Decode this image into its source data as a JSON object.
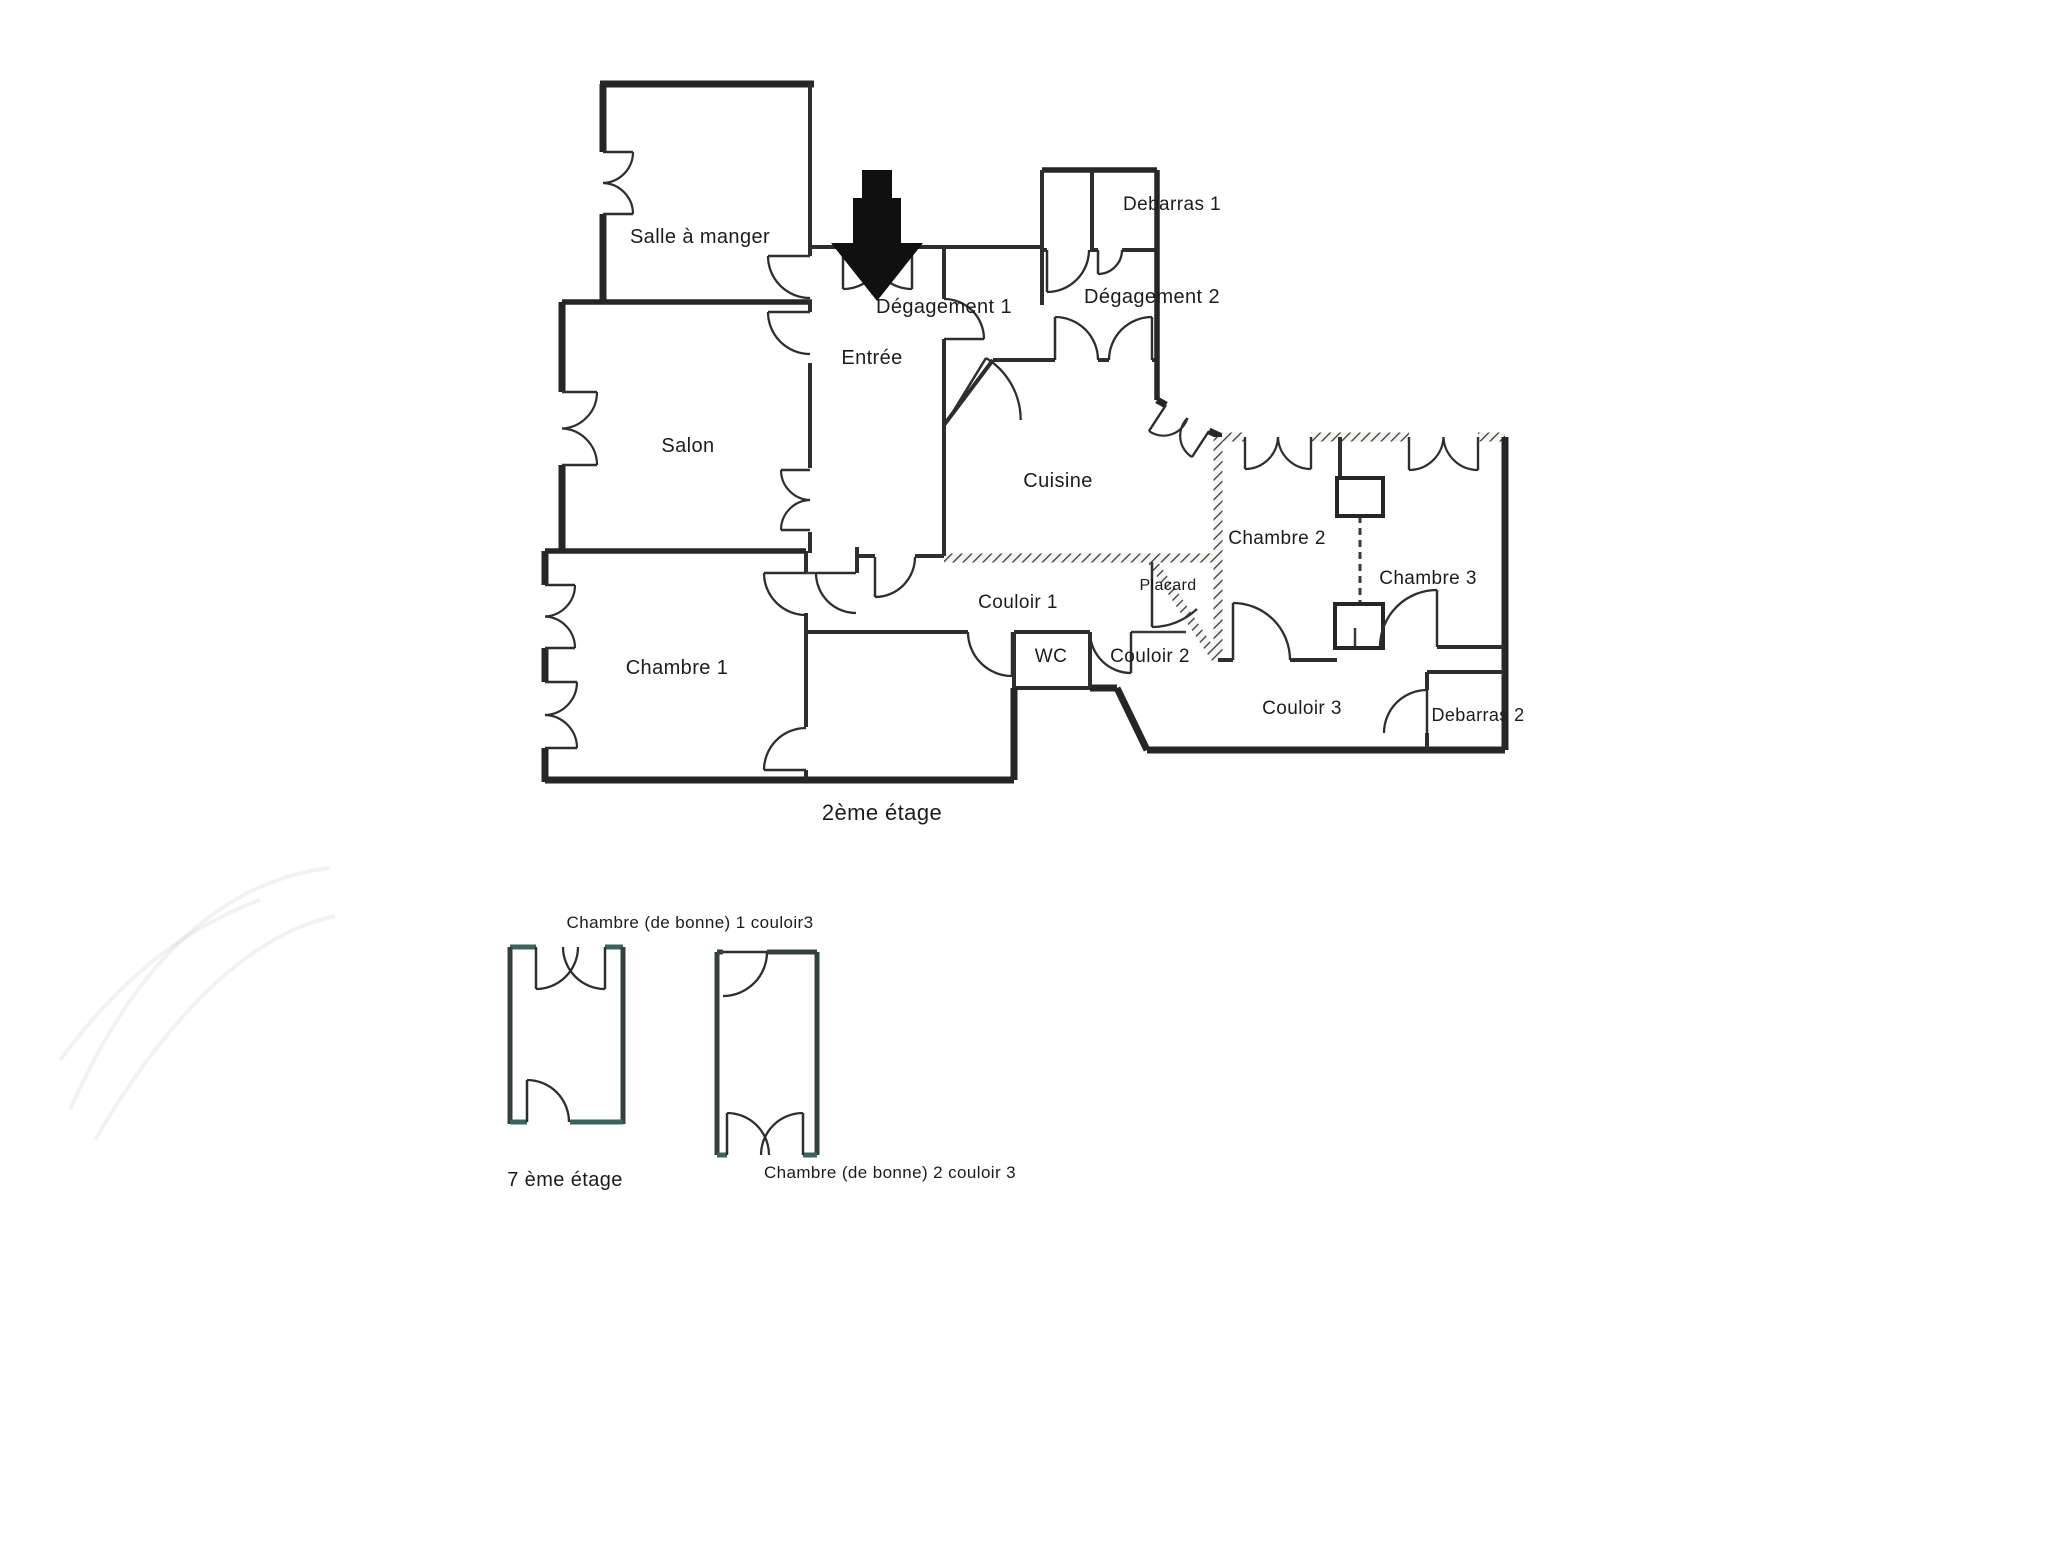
{
  "page": {
    "type": "scanned-floor-plan",
    "background": "#ffffff",
    "ink": "#262626",
    "teal_accent": "#3c635b"
  },
  "plan": {
    "floor_titles": [
      {
        "name": "floor-title-2eme-etage",
        "text": "2ème étage",
        "x": 882,
        "y": 820,
        "size": 22
      },
      {
        "name": "floor-title-7eme-etage",
        "text": "7 ème étage",
        "x": 565,
        "y": 1186,
        "size": 20
      }
    ],
    "labels": [
      {
        "name": "salle-a-manger",
        "text": "Salle à manger",
        "x": 700,
        "y": 243,
        "size": 20
      },
      {
        "name": "salon",
        "text": "Salon",
        "x": 688,
        "y": 452,
        "size": 20
      },
      {
        "name": "chambre-1",
        "text": "Chambre 1",
        "x": 677,
        "y": 674,
        "size": 20
      },
      {
        "name": "entree",
        "text": "Entrée",
        "x": 872,
        "y": 364,
        "size": 20
      },
      {
        "name": "degagement-1",
        "text": "Dégagement 1",
        "x": 944,
        "y": 313,
        "size": 20
      },
      {
        "name": "degagement-2",
        "text": "Dégagement 2",
        "x": 1152,
        "y": 303,
        "size": 20
      },
      {
        "name": "debarras-1",
        "text": "Debarras 1",
        "x": 1172,
        "y": 210,
        "size": 19
      },
      {
        "name": "cuisine",
        "text": "Cuisine",
        "x": 1058,
        "y": 487,
        "size": 20
      },
      {
        "name": "chambre-2",
        "text": "Chambre 2",
        "x": 1277,
        "y": 544,
        "size": 19
      },
      {
        "name": "chambre-3",
        "text": "Chambre 3",
        "x": 1428,
        "y": 584,
        "size": 19
      },
      {
        "name": "placard",
        "text": "Placard",
        "x": 1168,
        "y": 590,
        "size": 16
      },
      {
        "name": "couloir-1",
        "text": "Couloir 1",
        "x": 1018,
        "y": 608,
        "size": 19
      },
      {
        "name": "wc",
        "text": "WC",
        "x": 1051,
        "y": 662,
        "size": 19
      },
      {
        "name": "couloir-2",
        "text": "Couloir 2",
        "x": 1150,
        "y": 662,
        "size": 19
      },
      {
        "name": "couloir-3",
        "text": "Couloir 3",
        "x": 1302,
        "y": 714,
        "size": 19
      },
      {
        "name": "debarras-2",
        "text": "Debarras 2",
        "x": 1478,
        "y": 721,
        "size": 18
      },
      {
        "name": "chambre-bonne-1",
        "text": "Chambre (de bonne) 1 couloir3",
        "x": 690,
        "y": 928,
        "size": 17
      },
      {
        "name": "chambre-bonne-2",
        "text": "Chambre (de bonne) 2 couloir 3",
        "x": 890,
        "y": 1178,
        "size": 17
      }
    ],
    "walls": [
      {
        "x1": 600,
        "y1": 84,
        "x2": 814,
        "y2": 84,
        "t": "ext"
      },
      {
        "x1": 603,
        "y1": 84,
        "x2": 603,
        "y2": 152,
        "t": "ext"
      },
      {
        "x1": 603,
        "y1": 214,
        "x2": 603,
        "y2": 302,
        "t": "ext"
      },
      {
        "x1": 562,
        "y1": 302,
        "x2": 562,
        "y2": 392,
        "t": "ext"
      },
      {
        "x1": 562,
        "y1": 465,
        "x2": 562,
        "y2": 551,
        "t": "ext"
      },
      {
        "x1": 562,
        "y1": 302,
        "x2": 812,
        "y2": 302,
        "t": "mid"
      },
      {
        "x1": 545,
        "y1": 551,
        "x2": 806,
        "y2": 551,
        "t": "mid"
      },
      {
        "x1": 545,
        "y1": 551,
        "x2": 545,
        "y2": 585,
        "t": "ext"
      },
      {
        "x1": 545,
        "y1": 648,
        "x2": 545,
        "y2": 682,
        "t": "ext"
      },
      {
        "x1": 545,
        "y1": 748,
        "x2": 545,
        "y2": 782,
        "t": "ext"
      },
      {
        "x1": 545,
        "y1": 780,
        "x2": 1014,
        "y2": 780,
        "t": "ext"
      },
      {
        "x1": 810,
        "y1": 84,
        "x2": 810,
        "y2": 256,
        "t": "int"
      },
      {
        "x1": 810,
        "y1": 300,
        "x2": 810,
        "y2": 312,
        "t": "int"
      },
      {
        "x1": 810,
        "y1": 363,
        "x2": 810,
        "y2": 468,
        "t": "int"
      },
      {
        "x1": 810,
        "y1": 532,
        "x2": 810,
        "y2": 553,
        "t": "int"
      },
      {
        "x1": 806,
        "y1": 551,
        "x2": 806,
        "y2": 573,
        "t": "int"
      },
      {
        "x1": 806,
        "y1": 613,
        "x2": 806,
        "y2": 727,
        "t": "int"
      },
      {
        "x1": 806,
        "y1": 770,
        "x2": 806,
        "y2": 780,
        "t": "int"
      },
      {
        "x1": 806,
        "y1": 573,
        "x2": 816,
        "y2": 573,
        "t": "thin"
      },
      {
        "x1": 857,
        "y1": 547,
        "x2": 857,
        "y2": 573,
        "t": "int"
      },
      {
        "x1": 857,
        "y1": 556,
        "x2": 875,
        "y2": 556,
        "t": "int"
      },
      {
        "x1": 915,
        "y1": 556,
        "x2": 944,
        "y2": 556,
        "t": "int"
      },
      {
        "x1": 944,
        "y1": 558,
        "x2": 1218,
        "y2": 558,
        "t": "hatch"
      },
      {
        "x1": 810,
        "y1": 247,
        "x2": 843,
        "y2": 247,
        "t": "int"
      },
      {
        "x1": 912,
        "y1": 247,
        "x2": 1042,
        "y2": 247,
        "t": "int"
      },
      {
        "x1": 944,
        "y1": 247,
        "x2": 944,
        "y2": 299,
        "t": "int"
      },
      {
        "x1": 944,
        "y1": 339,
        "x2": 944,
        "y2": 556,
        "t": "int"
      },
      {
        "x1": 944,
        "y1": 425,
        "x2": 993,
        "y2": 360,
        "t": "int"
      },
      {
        "x1": 993,
        "y1": 360,
        "x2": 1055,
        "y2": 360,
        "t": "int"
      },
      {
        "x1": 1098,
        "y1": 360,
        "x2": 1109,
        "y2": 360,
        "t": "int"
      },
      {
        "x1": 1152,
        "y1": 360,
        "x2": 1157,
        "y2": 360,
        "t": "int"
      },
      {
        "x1": 1042,
        "y1": 170,
        "x2": 1157,
        "y2": 170,
        "t": "mid"
      },
      {
        "x1": 1042,
        "y1": 170,
        "x2": 1042,
        "y2": 305,
        "t": "int"
      },
      {
        "x1": 1092,
        "y1": 170,
        "x2": 1092,
        "y2": 250,
        "t": "int"
      },
      {
        "x1": 1042,
        "y1": 250,
        "x2": 1047,
        "y2": 250,
        "t": "int"
      },
      {
        "x1": 1090,
        "y1": 250,
        "x2": 1098,
        "y2": 250,
        "t": "int"
      },
      {
        "x1": 1122,
        "y1": 250,
        "x2": 1157,
        "y2": 250,
        "t": "int"
      },
      {
        "x1": 1157,
        "y1": 170,
        "x2": 1157,
        "y2": 400,
        "t": "mid"
      },
      {
        "x1": 1157,
        "y1": 400,
        "x2": 1166,
        "y2": 405,
        "t": "ext"
      },
      {
        "x1": 1209,
        "y1": 431,
        "x2": 1222,
        "y2": 437,
        "t": "ext"
      },
      {
        "x1": 1222,
        "y1": 437,
        "x2": 1245,
        "y2": 437,
        "t": "hatch"
      },
      {
        "x1": 1311,
        "y1": 437,
        "x2": 1409,
        "y2": 437,
        "t": "hatch"
      },
      {
        "x1": 1478,
        "y1": 437,
        "x2": 1505,
        "y2": 437,
        "t": "hatch"
      },
      {
        "x1": 1505,
        "y1": 437,
        "x2": 1505,
        "y2": 750,
        "t": "ext"
      },
      {
        "x1": 1147,
        "y1": 750,
        "x2": 1505,
        "y2": 750,
        "t": "ext"
      },
      {
        "x1": 1117,
        "y1": 688,
        "x2": 1147,
        "y2": 750,
        "t": "ext"
      },
      {
        "x1": 1090,
        "y1": 688,
        "x2": 1117,
        "y2": 688,
        "t": "ext"
      },
      {
        "x1": 1014,
        "y1": 688,
        "x2": 1090,
        "y2": 688,
        "t": "int"
      },
      {
        "x1": 1014,
        "y1": 632,
        "x2": 1014,
        "y2": 688,
        "t": "int"
      },
      {
        "x1": 1014,
        "y1": 688,
        "x2": 1014,
        "y2": 780,
        "t": "ext"
      },
      {
        "x1": 806,
        "y1": 632,
        "x2": 968,
        "y2": 632,
        "t": "int"
      },
      {
        "x1": 1014,
        "y1": 632,
        "x2": 1090,
        "y2": 632,
        "t": "int"
      },
      {
        "x1": 1131,
        "y1": 632,
        "x2": 1186,
        "y2": 632,
        "t": "thin"
      },
      {
        "x1": 1090,
        "y1": 632,
        "x2": 1090,
        "y2": 688,
        "t": "int"
      },
      {
        "x1": 1218,
        "y1": 437,
        "x2": 1218,
        "y2": 662,
        "t": "hatch"
      },
      {
        "x1": 1150,
        "y1": 558,
        "x2": 1218,
        "y2": 662,
        "t": "hatch"
      },
      {
        "x1": 1218,
        "y1": 660,
        "x2": 1233,
        "y2": 660,
        "t": "int"
      },
      {
        "x1": 1290,
        "y1": 660,
        "x2": 1337,
        "y2": 660,
        "t": "int"
      },
      {
        "x1": 1340,
        "y1": 437,
        "x2": 1340,
        "y2": 478,
        "t": "int"
      },
      {
        "x1": 1437,
        "y1": 647,
        "x2": 1505,
        "y2": 647,
        "t": "int"
      },
      {
        "x1": 1427,
        "y1": 672,
        "x2": 1505,
        "y2": 672,
        "t": "int"
      },
      {
        "x1": 1427,
        "y1": 672,
        "x2": 1427,
        "y2": 690,
        "t": "int"
      },
      {
        "x1": 1427,
        "y1": 733,
        "x2": 1427,
        "y2": 750,
        "t": "int"
      },
      {
        "x1": 510,
        "y1": 947,
        "x2": 536,
        "y2": 947,
        "t": "teal"
      },
      {
        "x1": 605,
        "y1": 947,
        "x2": 623,
        "y2": 947,
        "t": "teal"
      },
      {
        "x1": 510,
        "y1": 947,
        "x2": 510,
        "y2": 1124,
        "t": "ann"
      },
      {
        "x1": 623,
        "y1": 947,
        "x2": 623,
        "y2": 1124,
        "t": "ann"
      },
      {
        "x1": 510,
        "y1": 1122,
        "x2": 527,
        "y2": 1122,
        "t": "teal"
      },
      {
        "x1": 570,
        "y1": 1122,
        "x2": 623,
        "y2": 1122,
        "t": "teal"
      },
      {
        "x1": 717,
        "y1": 952,
        "x2": 723,
        "y2": 952,
        "t": "ann"
      },
      {
        "x1": 767,
        "y1": 952,
        "x2": 817,
        "y2": 952,
        "t": "ann"
      },
      {
        "x1": 717,
        "y1": 952,
        "x2": 717,
        "y2": 1155,
        "t": "ann"
      },
      {
        "x1": 817,
        "y1": 952,
        "x2": 817,
        "y2": 1155,
        "t": "ann"
      },
      {
        "x1": 717,
        "y1": 1155,
        "x2": 727,
        "y2": 1155,
        "t": "teal"
      },
      {
        "x1": 803,
        "y1": 1155,
        "x2": 817,
        "y2": 1155,
        "t": "teal"
      },
      {
        "x1": 1355,
        "y1": 628,
        "x2": 1355,
        "y2": 648,
        "t": "thin"
      }
    ],
    "dashed_walls": [
      {
        "x1": 1360,
        "y1": 516,
        "x2": 1360,
        "y2": 604,
        "t": "thin"
      }
    ],
    "chimney_rects": [
      {
        "x": 1337,
        "y": 478,
        "w": 46,
        "h": 38
      },
      {
        "x": 1335,
        "y": 604,
        "w": 48,
        "h": 44
      }
    ],
    "doors": [
      {
        "h": [
          810,
          256
        ],
        "a": [
          768,
          256
        ],
        "b": [
          810,
          300
        ]
      },
      {
        "h": [
          810,
          312
        ],
        "a": [
          768,
          312
        ],
        "b": [
          810,
          354
        ]
      },
      {
        "h": [
          843,
          247
        ],
        "a": [
          843,
          289
        ],
        "b": [
          879,
          247
        ]
      },
      {
        "h": [
          912,
          247
        ],
        "a": [
          912,
          289
        ],
        "b": [
          877,
          247
        ]
      },
      {
        "h": [
          944,
          339
        ],
        "a": [
          984,
          339
        ],
        "b": [
          944,
          299
        ]
      },
      {
        "h": [
          948,
          420
        ],
        "a": [
          986,
          358
        ],
        "b": [
          1020,
          420
        ]
      },
      {
        "h": [
          1047,
          250
        ],
        "a": [
          1047,
          292
        ],
        "b": [
          1089,
          250
        ]
      },
      {
        "h": [
          1098,
          250
        ],
        "a": [
          1098,
          274
        ],
        "b": [
          1122,
          250
        ]
      },
      {
        "h": [
          1055,
          360
        ],
        "a": [
          1055,
          317
        ],
        "b": [
          1098,
          360
        ]
      },
      {
        "h": [
          1152,
          360
        ],
        "a": [
          1152,
          317
        ],
        "b": [
          1109,
          360
        ]
      },
      {
        "h": [
          856,
          573
        ],
        "a": [
          816,
          573
        ],
        "b": [
          856,
          613
        ]
      },
      {
        "h": [
          875,
          557
        ],
        "a": [
          875,
          597
        ],
        "b": [
          915,
          557
        ]
      },
      {
        "h": [
          806,
          573
        ],
        "a": [
          764,
          573
        ],
        "b": [
          806,
          613
        ]
      },
      {
        "h": [
          806,
          770
        ],
        "a": [
          764,
          770
        ],
        "b": [
          806,
          728
        ]
      },
      {
        "h": [
          1012,
          632
        ],
        "a": [
          1012,
          676
        ],
        "b": [
          970,
          632
        ]
      },
      {
        "h": [
          1131,
          632
        ],
        "a": [
          1131,
          673
        ],
        "b": [
          1090,
          632
        ]
      },
      {
        "h": [
          1152,
          562
        ],
        "a": [
          1152,
          627
        ],
        "b": [
          1198,
          610
        ]
      },
      {
        "h": [
          1233,
          660
        ],
        "a": [
          1233,
          603
        ],
        "b": [
          1290,
          660
        ]
      },
      {
        "h": [
          1437,
          647
        ],
        "a": [
          1437,
          590
        ],
        "b": [
          1380,
          647
        ]
      },
      {
        "h": [
          1427,
          733
        ],
        "a": [
          1427,
          690
        ],
        "b": [
          1384,
          733
        ]
      },
      {
        "h": [
          536,
          947
        ],
        "a": [
          536,
          989
        ],
        "b": [
          570,
          947
        ]
      },
      {
        "h": [
          605,
          947
        ],
        "a": [
          605,
          989
        ],
        "b": [
          571,
          947
        ]
      },
      {
        "h": [
          527,
          1122
        ],
        "a": [
          527,
          1080
        ],
        "b": [
          569,
          1122
        ]
      },
      {
        "h": [
          723,
          952
        ],
        "a": [
          767,
          952
        ],
        "b": [
          723,
          996
        ]
      },
      {
        "h": [
          727,
          1155
        ],
        "a": [
          727,
          1113
        ],
        "b": [
          764,
          1155
        ]
      },
      {
        "h": [
          803,
          1155
        ],
        "a": [
          803,
          1113
        ],
        "b": [
          766,
          1155
        ]
      }
    ],
    "windows": [
      {
        "t1": [
          603,
          152
        ],
        "t2": [
          603,
          214
        ],
        "dx": 1,
        "dy": 0,
        "l": 30
      },
      {
        "t1": [
          562,
          392
        ],
        "t2": [
          562,
          465
        ],
        "dx": 1,
        "dy": 0,
        "l": 35
      },
      {
        "t1": [
          810,
          470
        ],
        "t2": [
          810,
          530
        ],
        "dx": -1,
        "dy": 0,
        "l": 29
      },
      {
        "t1": [
          545,
          585
        ],
        "t2": [
          545,
          648
        ],
        "dx": 1,
        "dy": 0,
        "l": 30
      },
      {
        "t1": [
          545,
          682
        ],
        "t2": [
          545,
          748
        ],
        "dx": 1,
        "dy": 0,
        "l": 32
      },
      {
        "t1": [
          1166,
          405
        ],
        "t2": [
          1209,
          431
        ],
        "dx": -0.55,
        "dy": 0.84,
        "l": 31
      },
      {
        "t1": [
          1245,
          437
        ],
        "t2": [
          1311,
          437
        ],
        "dx": 0,
        "dy": 1,
        "l": 32
      },
      {
        "t1": [
          1409,
          437
        ],
        "t2": [
          1478,
          437
        ],
        "dx": 0,
        "dy": 1,
        "l": 33
      }
    ],
    "entrance_arrow": {
      "name": "entrance-arrow",
      "points": [
        [
          862,
          170
        ],
        [
          892,
          170
        ],
        [
          892,
          198
        ],
        [
          901,
          198
        ],
        [
          901,
          243
        ],
        [
          923,
          243
        ],
        [
          877,
          301
        ],
        [
          831,
          243
        ],
        [
          853,
          243
        ],
        [
          853,
          198
        ],
        [
          862,
          198
        ]
      ]
    },
    "watermark_paths": [
      "M 70,1110 C 140,950 230,880 330,868",
      "M 95,1140 C 180,995 262,932 335,916",
      "M 60,1060 C 120,980 180,930 260,900"
    ]
  }
}
